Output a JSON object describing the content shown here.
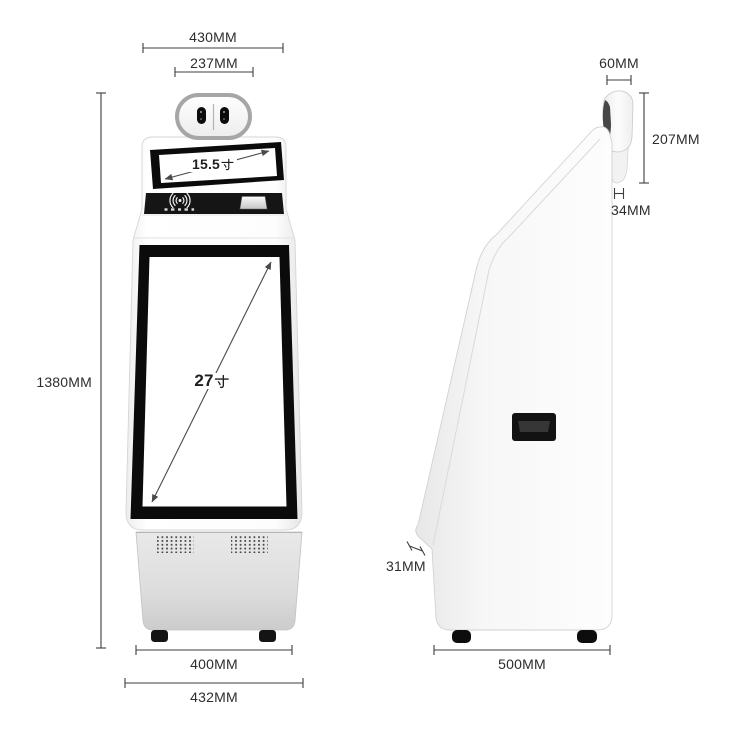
{
  "device": "self-service kiosk dimension diagram",
  "front_view": {
    "dimensions": {
      "top_width": "430MM",
      "camera_module_width": "237MM",
      "total_height": "1380MM",
      "base_width": "400MM",
      "overall_width": "432MM"
    },
    "screens": {
      "top_screen": {
        "value": "15.5",
        "unit": "寸"
      },
      "main_screen": {
        "value": "27",
        "unit": "寸"
      }
    },
    "features": [
      "dual-camera-module",
      "nfc-reader",
      "receipt-slot",
      "vent-grilles",
      "feet"
    ]
  },
  "side_view": {
    "dimensions": {
      "camera_head_width": "60MM",
      "camera_head_height": "207MM",
      "camera_mount_width": "34MM",
      "screen_panel_thickness": "31MM",
      "base_depth": "500MM"
    },
    "features": [
      "camera-head-profile",
      "side-slot",
      "feet"
    ]
  },
  "colors": {
    "background": "#ffffff",
    "dimension_line": "#3d3d3d",
    "label_text": "#2d2d2d",
    "screen_bezel": "#0b0b0b",
    "nfc_panel": "#151515",
    "body_white": "#fdfdfd",
    "base_gray": "#d6d6d6",
    "camera_ring": "#a6a6a6"
  }
}
